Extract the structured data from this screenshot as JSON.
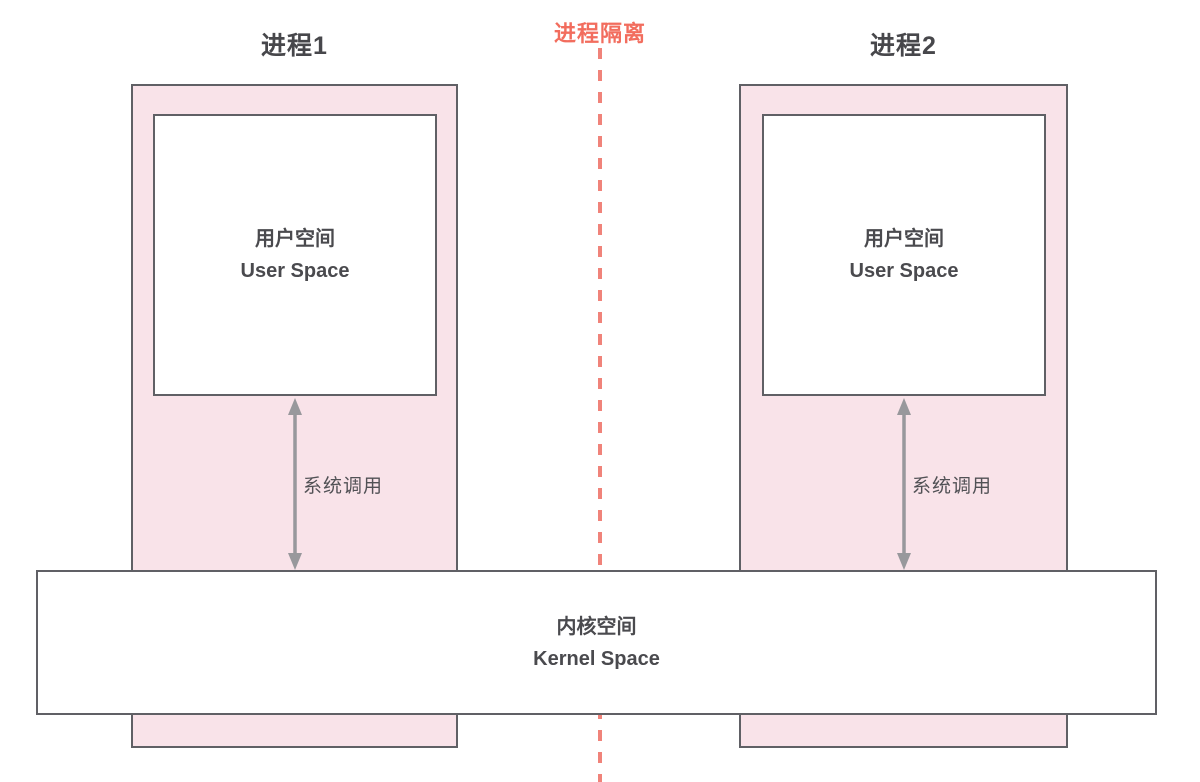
{
  "diagram": {
    "isolation_label": "进程隔离",
    "process1": {
      "title": "进程1",
      "user_space": {
        "zh": "用户空间",
        "en": "User Space"
      },
      "syscall_label": "系统调用"
    },
    "process2": {
      "title": "进程2",
      "user_space": {
        "zh": "用户空间",
        "en": "User Space"
      },
      "syscall_label": "系统调用"
    },
    "kernel": {
      "zh": "内核空间",
      "en": "Kernel Space"
    },
    "colors": {
      "process_fill_pink": "#f9e3e9",
      "box_border_gray": "#606065",
      "text_dark_gray": "#4a4a4e",
      "arrow_gray": "#98989c",
      "isolation_salmon": "#f26d5e"
    }
  }
}
